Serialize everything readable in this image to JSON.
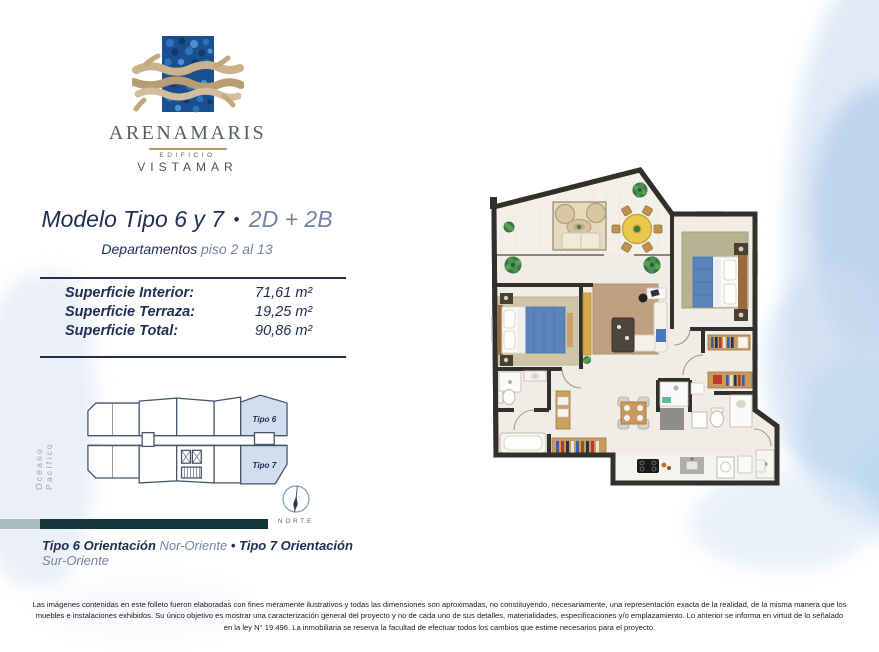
{
  "brand": {
    "name": "ARENAMARIS",
    "building_line1": "EDIFICIO",
    "building_line2": "VISTAMAR"
  },
  "header": {
    "title_main": "Modelo Tipo 6 y 7",
    "title_bullet": "•",
    "title_suffix": "2D + 2B",
    "subtitle_prefix": "Departamentos",
    "subtitle_suffix": "piso 2 al 13"
  },
  "areas": {
    "rows": [
      {
        "label": "Superficie Interior:",
        "value": "71,61 m²"
      },
      {
        "label": "Superficie Terraza:",
        "value": "19,25 m²"
      },
      {
        "label": "Superficie Total:",
        "value": "90,86 m²"
      }
    ]
  },
  "keyplan": {
    "ocean_label": "Océano Pacífico",
    "unit_labels": [
      "Tipo 6",
      "Tipo 7"
    ],
    "compass_label": "NORTE"
  },
  "orientation": {
    "tipo6_prefix": "Tipo 6 Orientación",
    "tipo6_value": "Nor-Oriente",
    "separator": "•",
    "tipo7_prefix": "Tipo 7 Orientación",
    "tipo7_value": "Sur-Oriente"
  },
  "disclaimer": "Las imágenes contenidas en este folleto fueron elaboradas con fines meramente ilustrativos y todas las dimensiones son aproximadas, no constituyendo, necesariamente, una representación exacta de la realidad, de la misma manera que los muebles e instalaciones exhibidos. Su único objetivo es mostrar una caracterización general del proyecto y no de cada uno de sus detalles, materialidades, especificaciones y/o emplazamiento. Lo anterior se informa en virtud de lo señalado en la ley N° 19.496. La inmobiliaria se reserva la facultad de efectuar todos los cambios que estime necesarios para el proyecto.",
  "colors": {
    "navy": "#222f55",
    "slate": "#76839f",
    "logo_gray": "#566069",
    "gold": "#b49b66",
    "teal_bar": "#14353b",
    "teal_bar_light": "#a9bdbe",
    "keyplan_line": "#46536b",
    "keyplan_highlight": "#cfdfee",
    "ocean_label_gray": "#9aa49e",
    "compass": "#51626f"
  }
}
